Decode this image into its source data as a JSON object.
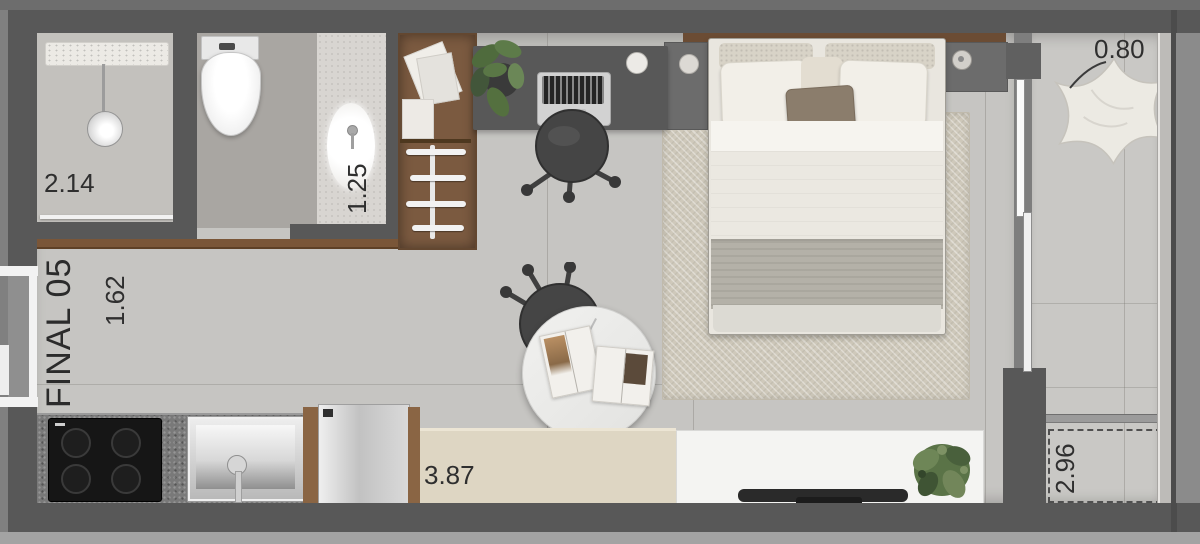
{
  "floor_plan": {
    "unit": {
      "label": "FINAL 05"
    },
    "dimensions": {
      "shower_width": "2.14",
      "vanity_width": "1.25",
      "entry_hall_width": "1.62",
      "kitchen_run": "3.87",
      "balcony_width": "0.80",
      "balcony_length": "2.96"
    },
    "furniture": [
      "towel-shelf",
      "shower-head",
      "toilet",
      "vanity-sink",
      "wardrobe",
      "desk",
      "laptop",
      "desk-chair",
      "monstera-plant",
      "bed",
      "nightstand-left",
      "nightstand-right",
      "area-rug",
      "round-table",
      "open-books",
      "table-chair",
      "cooktop",
      "kitchen-sink",
      "dishwasher",
      "bench",
      "tv-console",
      "soundbar",
      "console-plant",
      "pouf-chair",
      "ac-unit-area",
      "sliding-door",
      "entry-door"
    ],
    "colors": {
      "wall": "#585858",
      "floor": "#c6c5c2",
      "balcony_floor": "#c9c8c5",
      "wood_accent": "#7b5a40",
      "rug": "#cfc9bb",
      "bench": "#ded6c3",
      "label_text": "#2f2f2f"
    }
  }
}
